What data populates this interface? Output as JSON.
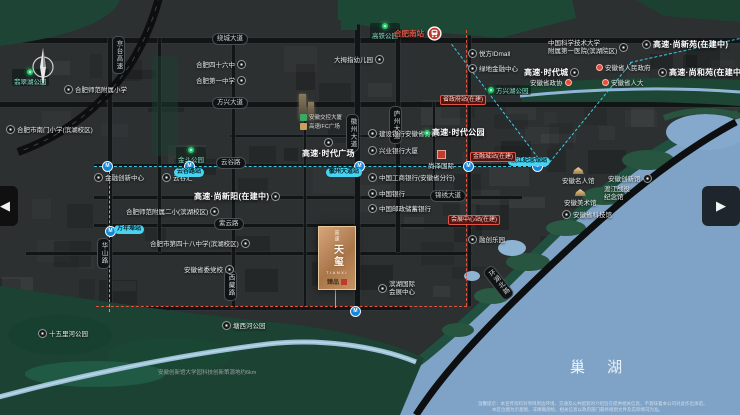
{
  "map": {
    "colors": {
      "land": "#2c3031",
      "park": "#1d4434",
      "water": "#7fa3c7",
      "metro_cyan": "#41d2f0",
      "metro_red": "#e2543f",
      "gold": "#caa06f"
    },
    "hefei_south": {
      "label": "合肥南站",
      "x": 394,
      "y": 26
    },
    "lake": {
      "label": "巢 湖"
    },
    "logo": {
      "brand": "高速",
      "name": "天玺",
      "latin": "TIANXI",
      "seal": "臻品"
    },
    "note": {
      "text": "安徽创新馆大学园科技创新策源地约6km"
    },
    "disclaimer": {
      "line1": "温馨提示：本宣传资料对项目周边环境、交通及公共配套的介绍旨在提供相关信息，不意味着本公司对此作出承诺。",
      "line2": "本区位图为示意图，非精确测绘，相关信息以政府部门最终规划文件及实际情况为准。"
    },
    "nav": {
      "prev": "◀",
      "next": "▶"
    },
    "pois": [
      {
        "label": "合肥四十六中",
        "x": 196,
        "y": 59,
        "icon": "circle",
        "side": "r"
      },
      {
        "label": "合肥第一中学",
        "x": 196,
        "y": 75,
        "icon": "circle",
        "side": "r"
      },
      {
        "label": "大拇指幼儿园",
        "x": 334,
        "y": 54,
        "icon": "circle",
        "side": "r"
      },
      {
        "label": "合肥师范附属小学",
        "x": 64,
        "y": 84,
        "icon": "circle",
        "side": "l"
      },
      {
        "label": "合肥市南门小学(滨湖校区)",
        "x": 6,
        "y": 124,
        "icon": "circle",
        "side": "l"
      },
      {
        "label": "金融创新中心",
        "x": 94,
        "y": 172,
        "icon": "circle",
        "side": "l"
      },
      {
        "label": "云谷汇",
        "x": 162,
        "y": 172,
        "icon": "circle",
        "side": "l"
      },
      {
        "label": "合肥师范附属二小(滨湖校区)",
        "x": 126,
        "y": 206,
        "icon": "circle",
        "side": "r"
      },
      {
        "label": "合肥市第四十八中学(滨湖校区)",
        "x": 150,
        "y": 238,
        "icon": "circle",
        "side": "r"
      },
      {
        "label": "安徽省委党校",
        "x": 184,
        "y": 264,
        "icon": "circle",
        "side": "r"
      },
      {
        "label": "建设银行安徽省分行",
        "x": 368,
        "y": 128,
        "icon": "circle",
        "side": "l"
      },
      {
        "label": "兴业银行大厦",
        "x": 368,
        "y": 145,
        "icon": "circle",
        "side": "l"
      },
      {
        "label": "中国工商银行(安徽省分行)",
        "x": 368,
        "y": 172,
        "icon": "circle",
        "side": "l"
      },
      {
        "label": "中国银行",
        "x": 368,
        "y": 188,
        "icon": "circle",
        "side": "l"
      },
      {
        "label": "中国邮政储蓄银行",
        "x": 368,
        "y": 203,
        "icon": "circle",
        "side": "l"
      },
      {
        "label": "悦方IDmall",
        "x": 468,
        "y": 48,
        "icon": "circle",
        "side": "l"
      },
      {
        "label": "绿地金融中心",
        "x": 468,
        "y": 63,
        "icon": "circle",
        "side": "l"
      },
      {
        "label": "安徽省人民政府",
        "x": 596,
        "y": 62,
        "icon": "red-dot",
        "side": "l"
      },
      {
        "label": "安徽省政协",
        "x": 530,
        "y": 77,
        "icon": "red-dot",
        "side": "r"
      },
      {
        "label": "安徽省人大",
        "x": 602,
        "y": 77,
        "icon": "red-dot",
        "side": "l"
      },
      {
        "label": "尚泽国际",
        "x": 428,
        "y": 150,
        "icon": "red-square",
        "side": "t"
      },
      {
        "label": "融创乐园",
        "x": 468,
        "y": 234,
        "icon": "circle",
        "side": "l"
      },
      {
        "label": "安徽名人馆",
        "x": 562,
        "y": 167,
        "icon": "gold",
        "side": "t"
      },
      {
        "label": "安徽创新馆",
        "x": 608,
        "y": 173,
        "icon": "circle",
        "side": "r"
      },
      {
        "label": "安徽美术馆",
        "x": 564,
        "y": 189,
        "icon": "gold",
        "side": "t"
      },
      {
        "label": "安徽省科技馆",
        "x": 562,
        "y": 209,
        "icon": "circle",
        "side": "l"
      },
      {
        "label": "塘西河公园",
        "x": 222,
        "y": 320,
        "icon": "circle",
        "side": "l"
      },
      {
        "label": "十五里河公园",
        "x": 38,
        "y": 328,
        "icon": "circle",
        "side": "l"
      }
    ],
    "pois_two_line": [
      {
        "lines": [
          "中国科学技术大学",
          "附属第一医院(滨湖院区)"
        ],
        "x": 548,
        "y": 40,
        "icon": "circle",
        "side": "r"
      },
      {
        "lines": [
          "渡江战役",
          "纪念馆"
        ],
        "x": 604,
        "y": 186,
        "icon": "none",
        "side": "l"
      },
      {
        "lines": [
          "滨湖国际",
          "会展中心"
        ],
        "x": 378,
        "y": 281,
        "icon": "circle",
        "side": "l"
      }
    ],
    "projects": [
      {
        "label": "高速·时代广场",
        "x": 302,
        "y": 138,
        "icon": "circle",
        "side": "t"
      },
      {
        "label": "高速·时代公园",
        "x": 424,
        "y": 127,
        "icon": "green-dot",
        "side": "l"
      },
      {
        "label": "高速·时代城",
        "x": 524,
        "y": 67,
        "icon": "circle",
        "side": "r"
      },
      {
        "label": "高速·尚新苑(在建中)",
        "x": 642,
        "y": 39,
        "icon": "circle",
        "side": "l"
      },
      {
        "label": "高速·尚和苑(在建中)",
        "x": 658,
        "y": 67,
        "icon": "circle",
        "side": "l"
      },
      {
        "label": "高速·尚新阳(在建中)",
        "x": 194,
        "y": 191,
        "icon": "circle",
        "side": "r"
      }
    ],
    "parks": [
      {
        "label": "高铁公园",
        "x": 370,
        "y": 23,
        "side": "t"
      },
      {
        "label": "翡翠湖公园",
        "x": 12,
        "y": 69,
        "side": "t"
      },
      {
        "label": "金斗公园",
        "x": 176,
        "y": 147,
        "side": "t"
      },
      {
        "label": "方兴湖公园",
        "x": 486,
        "y": 85,
        "side": "l"
      }
    ],
    "mini_logos": [
      {
        "label": "安徽交控大厦",
        "x": 300,
        "y": 113,
        "color": "#3da864"
      },
      {
        "label": "高速IFC广场",
        "x": 300,
        "y": 122,
        "color": "#c9a05c"
      }
    ],
    "roads_h": [
      {
        "label": "绕城大道",
        "x": 212,
        "y": 33
      },
      {
        "label": "方兴大道",
        "x": 212,
        "y": 97
      },
      {
        "label": "云谷路",
        "x": 216,
        "y": 157
      },
      {
        "label": "锦绣大道",
        "x": 430,
        "y": 190
      },
      {
        "label": "紫云路",
        "x": 214,
        "y": 218
      }
    ],
    "roads_v": [
      {
        "label": "京台高速",
        "x": 112,
        "y": 36
      },
      {
        "label": "华山路",
        "x": 97,
        "y": 238
      },
      {
        "label": "徽州大道",
        "x": 346,
        "y": 114
      },
      {
        "label": "庐州大道",
        "x": 389,
        "y": 106
      },
      {
        "label": "西藏路",
        "x": 224,
        "y": 270
      },
      {
        "label": "环湖北路",
        "x": 492,
        "y": 264,
        "rot": 52
      }
    ],
    "metro_stations": [
      {
        "label": "云谷路站",
        "x": 174,
        "y": 168
      },
      {
        "label": "万年埠站",
        "x": 114,
        "y": 225
      },
      {
        "label": "徽州大道站",
        "x": 326,
        "y": 168
      },
      {
        "label": "渡江纪念馆站",
        "x": 508,
        "y": 157
      }
    ],
    "metro_dots": [
      [
        102,
        161
      ],
      [
        184,
        161
      ],
      [
        354,
        161
      ],
      [
        463,
        161
      ],
      [
        532,
        161
      ],
      [
        105,
        226
      ],
      [
        350,
        306
      ]
    ],
    "stations_red": [
      {
        "label": "省政府站(在建)",
        "x": 440,
        "y": 95
      },
      {
        "label": "金融城站(在建)",
        "x": 470,
        "y": 152
      },
      {
        "label": "会展中心站(在建)",
        "x": 448,
        "y": 215
      }
    ]
  }
}
